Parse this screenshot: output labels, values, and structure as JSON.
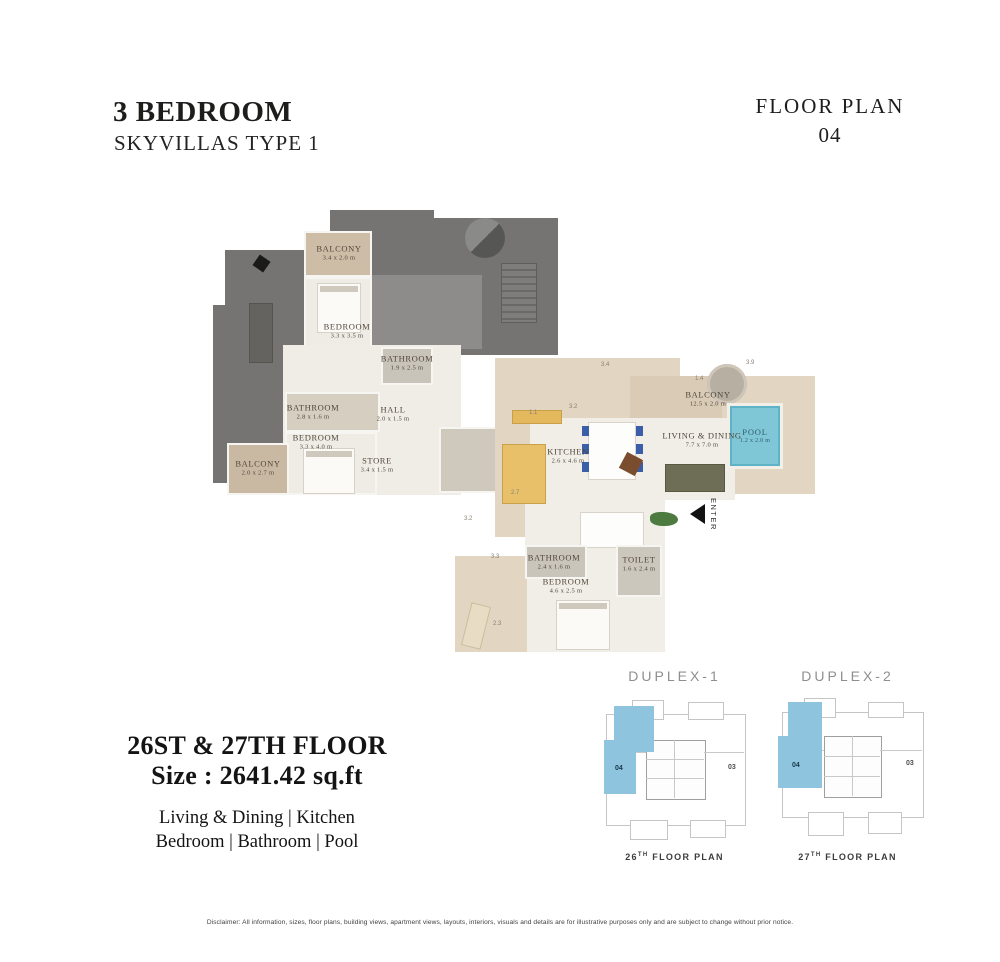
{
  "header": {
    "title": "3 BEDROOM",
    "subtitle": "SKYVILLAS TYPE 1",
    "plan_label": "FLOOR PLAN",
    "plan_number": "04"
  },
  "upper_plan": {
    "rooms": [
      {
        "label": "BALCONY",
        "dims": "3.4 x 2.0 m"
      },
      {
        "label": "BEDROOM",
        "dims": "3.3 x 3.5 m"
      },
      {
        "label": "BATHROOM",
        "dims": "1.9 x 2.5 m"
      },
      {
        "label": "BATHROOM",
        "dims": "2.8 x 1.6 m"
      },
      {
        "label": "HALL",
        "dims": "2.0 x 1.5 m"
      },
      {
        "label": "BEDROOM",
        "dims": "3.3 x 4.0 m"
      },
      {
        "label": "BALCONY",
        "dims": "2.0 x 2.7 m"
      },
      {
        "label": "STORE",
        "dims": "3.4 x 1.5 m"
      }
    ]
  },
  "lower_plan": {
    "rooms": [
      {
        "label": "BALCONY",
        "dims": "12.5 x 2.0 m"
      },
      {
        "label": "POOL",
        "dims": "1.2 x 2.0 m"
      },
      {
        "label": "LIVING & DINING",
        "dims": "7.7 x 7.0 m"
      },
      {
        "label": "KITCHEN",
        "dims": "2.6 x 4.6 m"
      },
      {
        "label": "BATHROOM",
        "dims": "2.4 x 1.6 m"
      },
      {
        "label": "TOILET",
        "dims": "1.6 x 2.4 m"
      },
      {
        "label": "BEDROOM",
        "dims": "4.6 x 2.5 m"
      }
    ],
    "enter_label": "ENTER",
    "edge_dims": [
      "3.4",
      "3.9",
      "1.4",
      "3.2",
      "1.1",
      "2.7",
      "3.2",
      "3.3",
      "2.3"
    ]
  },
  "details": {
    "floor_line": "26ST & 27TH FLOOR",
    "size_line": "Size : 2641.42 sq.ft",
    "features_line1": "Living & Dining | Kitchen",
    "features_line2": "Bedroom | Bathroom | Pool"
  },
  "key_plans": [
    {
      "title": "DUPLEX-1",
      "caption_floor": "26",
      "caption_sup": "TH",
      "caption_text": " FLOOR PLAN",
      "unit_highlight": "04",
      "unit_other": "03"
    },
    {
      "title": "DUPLEX-2",
      "caption_floor": "27",
      "caption_sup": "TH",
      "caption_text": " FLOOR PLAN",
      "unit_highlight": "04",
      "unit_other": "03"
    }
  ],
  "disclaimer": "Disclaimer: All information, sizes, floor plans, building views, apartment views, layouts, interiors, visuals and details are for illustrative purposes only and are subject to change without prior notice.",
  "colors": {
    "pool_blue": "#7fc6d6",
    "keyplan_highlight": "#8ec4dd",
    "terrace_dark": "#757472",
    "terrace_light": "#8d8c8a",
    "balcony_beige": "#cdbda6",
    "floor_beige": "#e2d5c1",
    "text_dark": "#1d1d1b"
  }
}
